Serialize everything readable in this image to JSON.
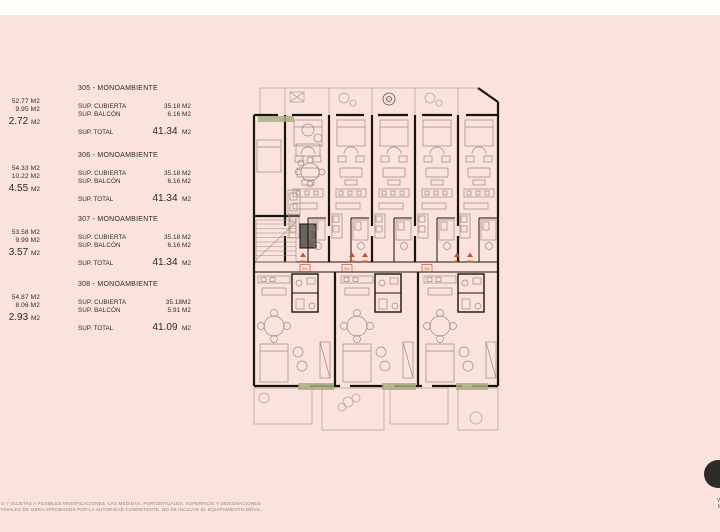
{
  "colors": {
    "background": "#fbe2dd",
    "top_strip": "#fffdfa",
    "ink": "#2e2a28",
    "wall": "#171412",
    "furniture_line": "#9b8c82",
    "terrace_line": "#b6a69e",
    "planter_green": "#a9ae82",
    "marker_orange": "#c3552b",
    "logo_circle": "#2e2a28"
  },
  "clipped_left_column": [
    {
      "line1": "52.77 M2",
      "line2": "9.95 M2",
      "total_value": "2.72",
      "total_unit": "M2"
    },
    {
      "line1": "54.33 M2",
      "line2": "10.22 M2",
      "total_value": "4.55",
      "total_unit": "M2"
    },
    {
      "line1": "53.58 M2",
      "line2": "9.99 M2",
      "total_value": "3.57",
      "total_unit": "M2"
    },
    {
      "line1": "54.87 M2",
      "line2": "8.06 M2",
      "total_value": "2.93",
      "total_unit": "M2"
    }
  ],
  "units": [
    {
      "title": "305 - MONOAMBIENTE",
      "row1_label": "SUP. CUBIERTA",
      "row1_value": "35.18 M2",
      "row2_label": "SUP. BALCÓN",
      "row2_value": "6.16 M2",
      "total_label": "SUP. TOTAL",
      "total_value": "41.34",
      "total_unit": "M2"
    },
    {
      "title": "306 - MONOAMBIENTE",
      "row1_label": "SUP. CUBIERTA",
      "row1_value": "35.18 M2",
      "row2_label": "SUP. BALCÓN",
      "row2_value": "6.16 M2",
      "total_label": "SUP. TOTAL",
      "total_value": "41.34",
      "total_unit": "M2"
    },
    {
      "title": "307 - MONOAMBIENTE",
      "row1_label": "SUP. CUBIERTA",
      "row1_value": "35.18 M2",
      "row2_label": "SUP. BALCÓN",
      "row2_value": "6.16 M2",
      "total_label": "SUP. TOTAL",
      "total_value": "41.34",
      "total_unit": "M2"
    },
    {
      "title": "308 - MONOAMBIENTE",
      "row1_label": "SUP. CUBIERTA",
      "row1_value": "35.18M2",
      "row2_label": "SUP. BALCÓN",
      "row2_value": "5.91 M2",
      "total_label": "SUP. TOTAL",
      "total_value": "41.09",
      "total_unit": "M2"
    }
  ],
  "plan": {
    "markers_top": [
      "304",
      "305",
      "306",
      "307",
      "308"
    ],
    "markers_bottom": [
      "301",
      "302",
      "303"
    ]
  },
  "disclaimer": {
    "line1": "O Y SUJETAS A POSIBLES MODIFICACIONES. LAS MEDIDAS, PORCENTUALES, SUPERFICIE Y DESIGNACIONES",
    "line2": "FINALES DE OBRA APROBADOS POR LA AUTORIDAD COMPETENTE. NO SE INCLUYE EL EQUIPAMIENTO MÓVIL."
  },
  "brand": {
    "line1": "W",
    "line2": "M"
  }
}
